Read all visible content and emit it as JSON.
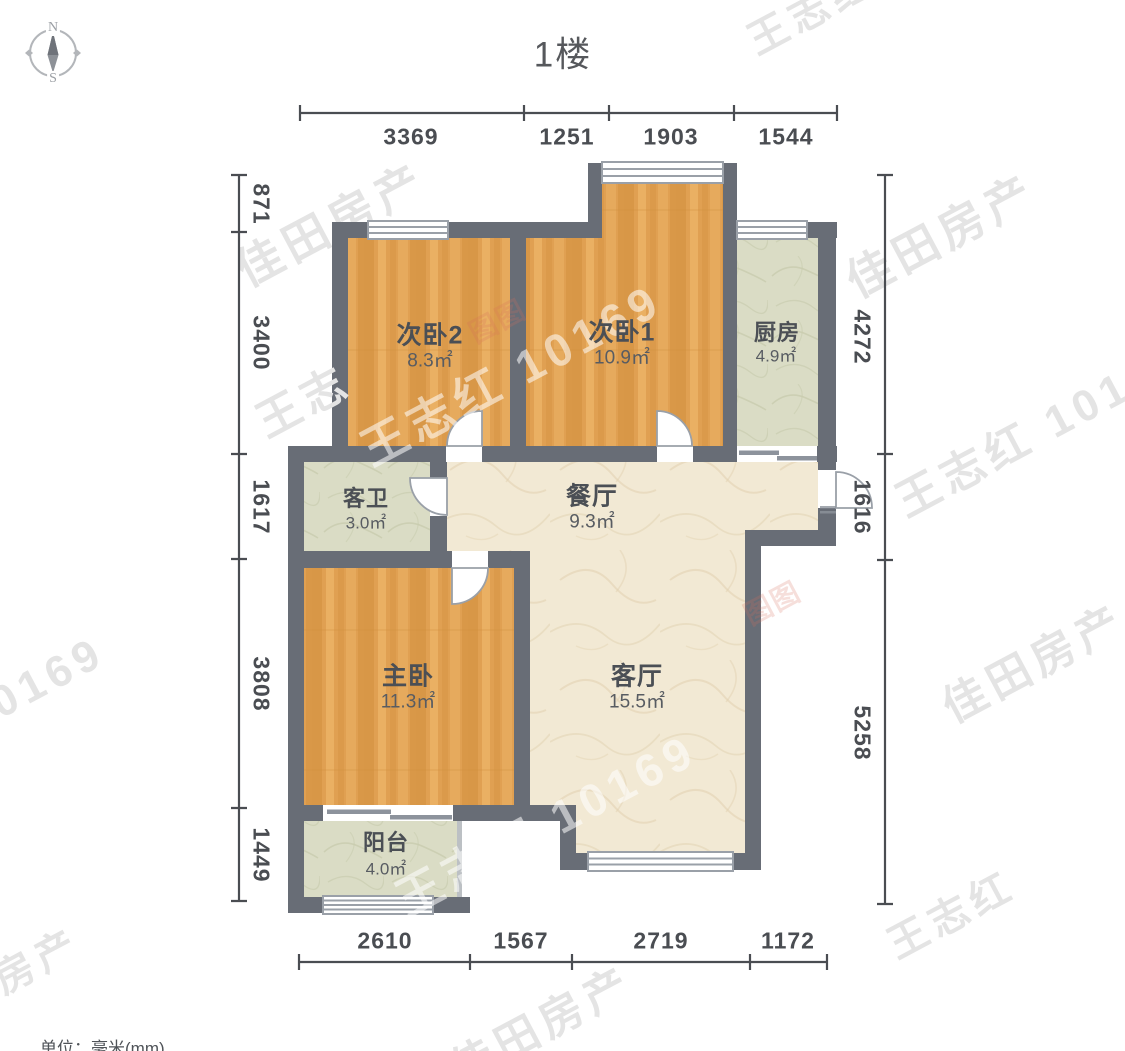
{
  "title": "1楼",
  "unit_note": "单位：毫米(mm)",
  "compass": {
    "north": "N",
    "south": "S"
  },
  "rooms": [
    {
      "id": "bedroom2",
      "name": "次卧2",
      "area": "8.3㎡"
    },
    {
      "id": "bedroom1",
      "name": "次卧1",
      "area": "10.9㎡"
    },
    {
      "id": "kitchen",
      "name": "厨房",
      "area": "4.9㎡"
    },
    {
      "id": "bathroom",
      "name": "客卫",
      "area": "3.0㎡"
    },
    {
      "id": "dining",
      "name": "餐厅",
      "area": "9.3㎡"
    },
    {
      "id": "master",
      "name": "主卧",
      "area": "11.3㎡"
    },
    {
      "id": "living",
      "name": "客厅",
      "area": "15.5㎡"
    },
    {
      "id": "balcony",
      "name": "阳台",
      "area": "4.0㎡"
    }
  ],
  "dimensions": {
    "top": [
      "3369",
      "1251",
      "1903",
      "1544"
    ],
    "bottom": [
      "2610",
      "1567",
      "2719",
      "1172"
    ],
    "left": [
      "871",
      "3400",
      "1617",
      "3808",
      "1449"
    ],
    "right": [
      "4272",
      "1616",
      "5258"
    ]
  },
  "watermarks": [
    {
      "text": "佳田房产"
    },
    {
      "text": "佳田房产"
    },
    {
      "text": "王志红"
    },
    {
      "text": "王志红 101"
    },
    {
      "text": "佳田房产"
    },
    {
      "text": "0169"
    },
    {
      "text": "王志红 10169"
    },
    {
      "text": "王志红 10169"
    },
    {
      "text": "王志红"
    },
    {
      "text": "佳田房产"
    },
    {
      "text": "房产"
    },
    {
      "text": "王志"
    },
    {
      "text": "图图"
    },
    {
      "text": "图图"
    }
  ],
  "colors": {
    "wall": "#686d76",
    "wood": "#e0a052",
    "wood_dark": "#d18f3e",
    "wood_light": "#ecb468",
    "tile": "#dadcc5",
    "tile_vein": "#c6caab",
    "marble": "#f2e9d4",
    "marble_vein": "#e2d2b2",
    "dim": "#4a4d52",
    "label": "#4b4f55",
    "area_label": "#585c62",
    "title": "#56585c",
    "window_line": "#9aa0a8",
    "wm_gray": "#e4e4e4",
    "wm_white": "rgba(255,255,255,0.55)",
    "wm_red": "rgba(214,108,92,0.22)"
  }
}
